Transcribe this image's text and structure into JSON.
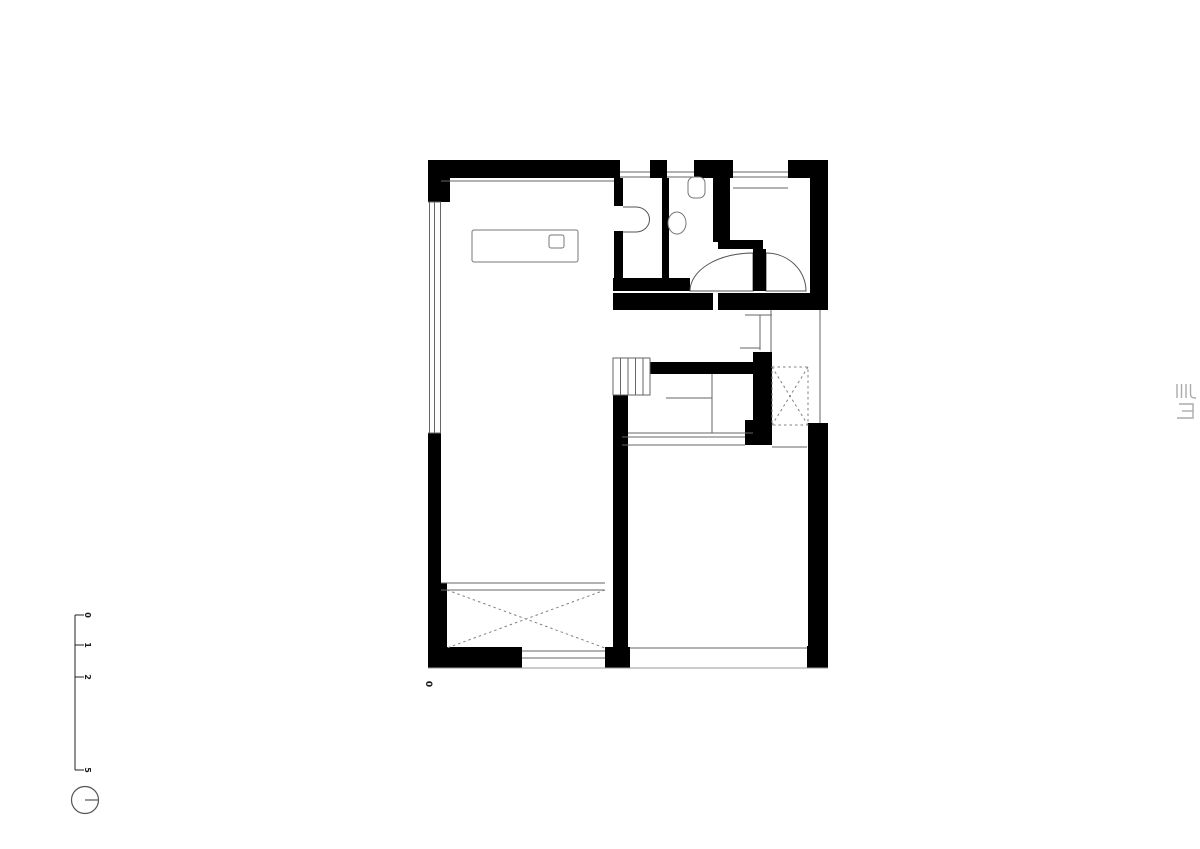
{
  "scale_bar": {
    "labels": [
      "0",
      "1",
      "2",
      "5"
    ]
  },
  "level_marker": {
    "label": "0"
  },
  "colors": {
    "background": "#ffffff",
    "wall": "#000000",
    "thin_line": "#666666",
    "light_line": "#999999",
    "dashed_line": "#808080",
    "scale_line": "#222222",
    "logo": "#aaaaaa"
  },
  "icons": {
    "orientation_symbol": "circle-with-radius-line",
    "studio_logo": "maze-glyph-logo",
    "stairs": "stair-treads",
    "toilet": "wc-pan",
    "sink": "oval-basin",
    "table": "rectangular-table",
    "void_hatch": "dashed-x-cross"
  }
}
